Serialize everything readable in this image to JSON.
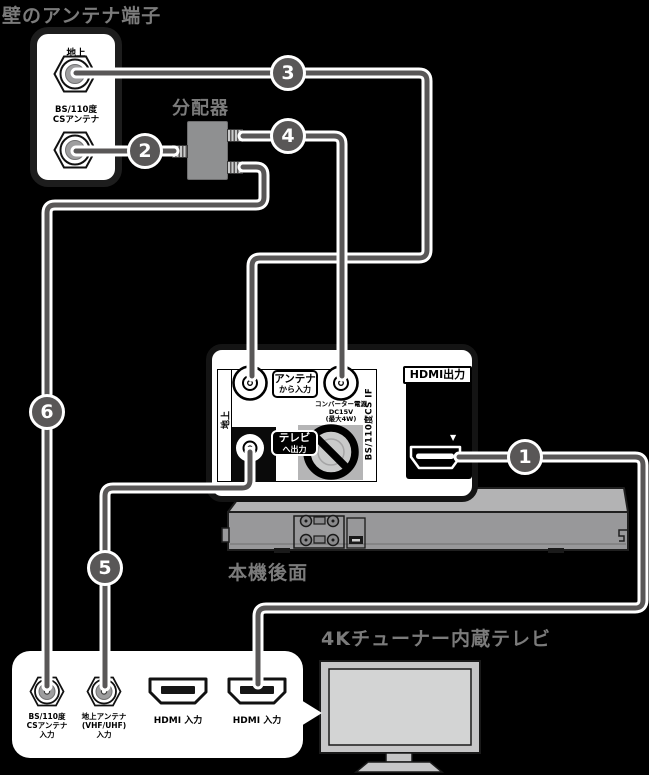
{
  "page": {
    "wall_title": "壁のアンテナ端子",
    "splitter_label": "分配器",
    "device_label": "本機後面",
    "tv_title": "4Kチューナー内蔵テレビ"
  },
  "wall_panel": {
    "terrestrial": "地上",
    "bscs_line1": "BS/110度",
    "bscs_line2": "CSアンテナ"
  },
  "recorder": {
    "side_terrestrial": "地上",
    "antenna_in_line1": "アンテナ",
    "antenna_in_line2": "から入力",
    "converter_line1": "コンバーター電源",
    "converter_line2": "DC15V",
    "converter_line3": "(最大4W)",
    "tv_out_line1": "テレビ",
    "tv_out_line2": "へ出力",
    "bscs_if": "BS/110度CS IF",
    "hdmi_out": "HDMI出力",
    "hdmi_marker": "▼"
  },
  "tv_panel": {
    "bscs_line1": "BS/110度",
    "bscs_line2": "CSアンテナ",
    "bscs_line3": "入力",
    "terr_line1": "地上アンテナ",
    "terr_line2": "(VHF/UHF)",
    "terr_line3": "入力",
    "hdmi1": "HDMI 入力",
    "hdmi2": "HDMI 入力"
  },
  "badges": [
    "1",
    "2",
    "3",
    "4",
    "5",
    "6"
  ],
  "colors": {
    "background": "#000000",
    "cable": "#595757",
    "cable_outline": "#ffffff",
    "badge_fill": "#595757",
    "label_gray": "#7b7b7b",
    "panel_white": "#ffffff",
    "splitter_gray": "#8f9091",
    "caution_gray": "#b5b5b6",
    "connector_gray": "#9e9e9f"
  }
}
